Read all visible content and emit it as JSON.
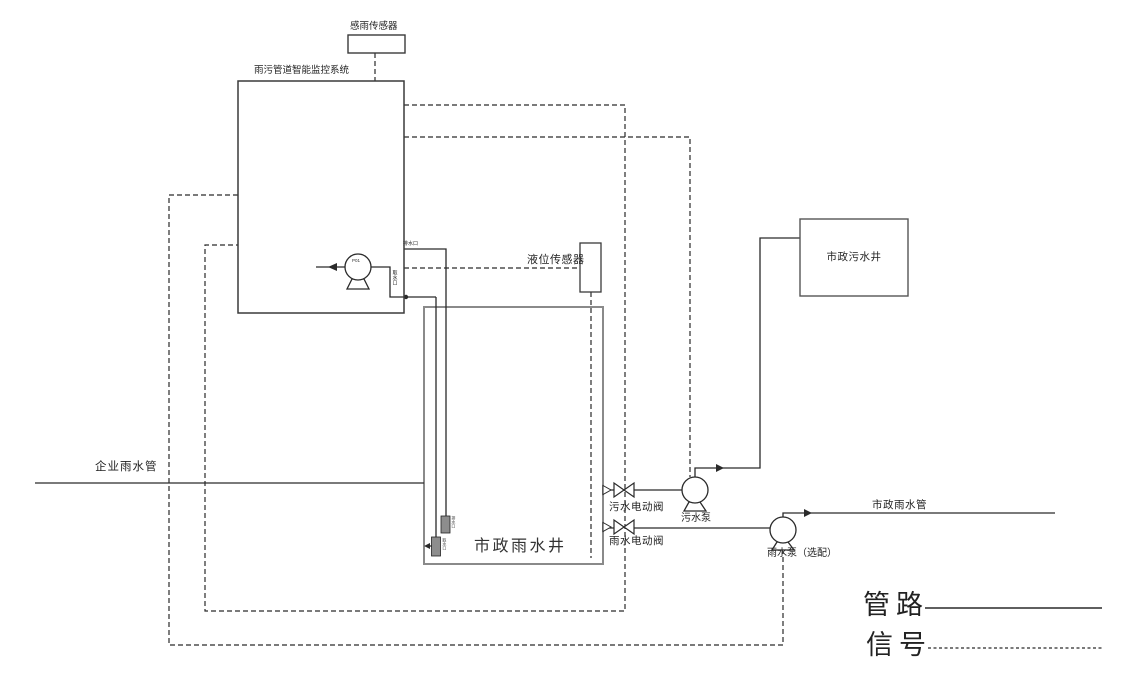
{
  "labels": {
    "rain_sensor": "感雨传感器",
    "monitor_system": "雨污管道智能监控系统",
    "level_sensor": "液位传感器",
    "sewage_well": "市政污水井",
    "rain_well": "市政雨水井",
    "enterprise_rain_pipe": "企业雨水管",
    "sewage_valve": "污水电动阀",
    "sewage_pump": "污水泵",
    "rain_valve": "雨水电动阀",
    "rain_pump": "雨水泵（选配）",
    "municipal_rain_pipe": "市政雨水管",
    "drain_outlet": "排水口",
    "water_intake": "取水口",
    "drain_strainer": "排水口",
    "intake_strainer": "取水口",
    "pump_tag": "P01"
  },
  "legend": {
    "pipe": "管路",
    "signal": "信号"
  },
  "colors": {
    "line": "#2a2a2a",
    "tank_wall": "#8a8a8a",
    "background": "#ffffff"
  }
}
